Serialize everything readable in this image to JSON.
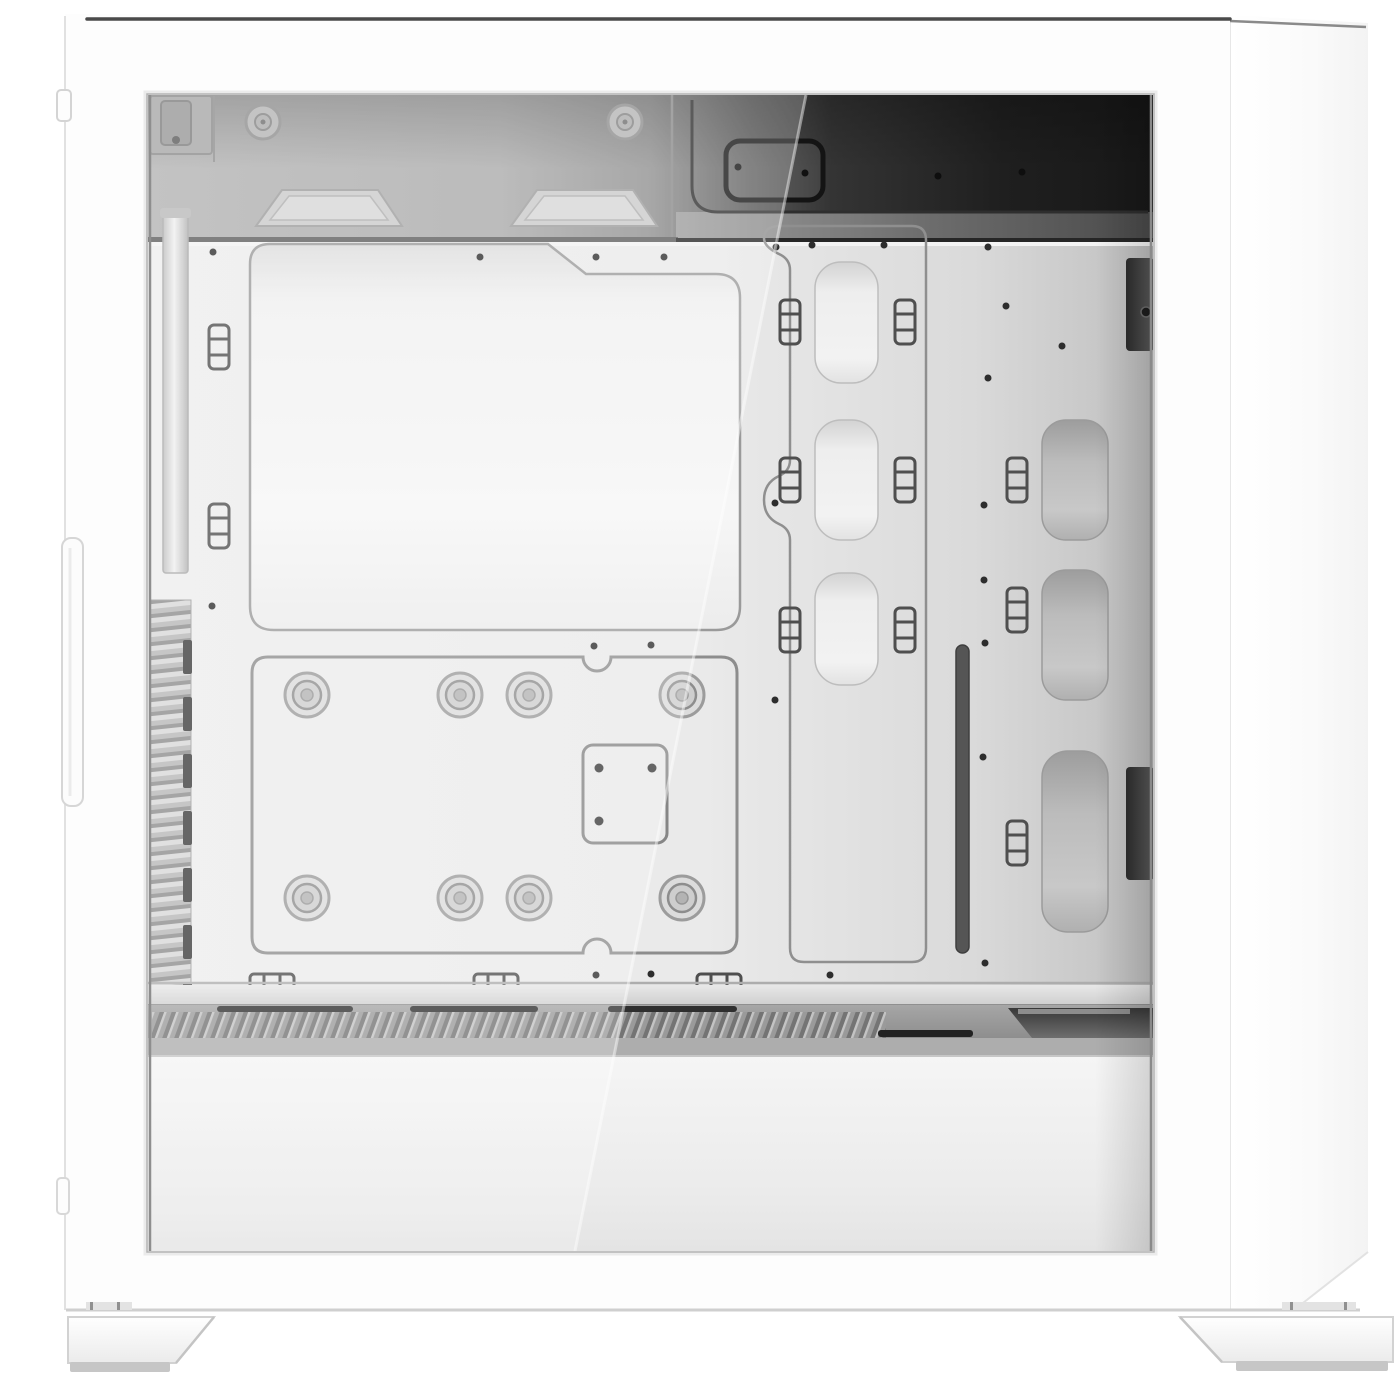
{
  "meta": {
    "image_type": "product-photo",
    "subject": "White mid-tower PC case, side view with tempered glass panel showing empty white interior",
    "visible_text": ""
  },
  "colors": {
    "background": "#ffffff",
    "case-white": "#fdfdfd",
    "top-line": "#4a4a4a",
    "outline": "#8f8f8f",
    "dot": "#2d2d2d",
    "tray-light": "#ececec",
    "tray-dark": "#c2c2c2",
    "band-light": "#b0b0b0",
    "band-dark": "#1b1b1b",
    "cutout-fill": "#f2f2f2",
    "shroud-gray": "#9a9a9a",
    "slot-dark": "#333333",
    "rail-gray": "#dedede",
    "foot-pad": "#c6c6c6"
  },
  "parts": {
    "stage": "White mid-tower PC case - left side view with tempered glass panel",
    "front_frame": "White case frame around glass panel",
    "side_panel": "Case right side face",
    "top_edge": "Case top edge line",
    "glass": "Tempered glass side window",
    "interior_top": "Interior ceiling area with fan mounting tabs",
    "ceiling_cutout": "Top cable routing cutout",
    "fan_tabs": "Top fan mounting tabs",
    "mb_tray": "Motherboard tray",
    "upper_cutout": "Motherboard tray upper cutout",
    "backplate_panel": "CPU backplate access panel",
    "grommets": "Standoff grommets on backplate panel",
    "cpu_square": "CPU backplate mounting square",
    "cable_column": "Cable routing channel with three cutouts",
    "column_cutouts": "Cable pass-through cutouts",
    "tie_clips": "Cable tie clips",
    "rear_cutouts": "Rear cable cutouts",
    "thin_slot": "Thin vertical vent slot",
    "rear_brackets": "Rear panel brackets seen through glass",
    "tray_rail": "Tray bottom rail",
    "psu_shroud": "Power supply shroud",
    "shroud_grille": "Shroud ventilation grille",
    "psu_recess": "PSU vent recess",
    "lower_band": "Lower white band behind glass",
    "front_vent": "Front intake vent louvers",
    "front_rail": "Front radiator mounting rail",
    "reflection": "Diagonal glass reflection",
    "seam": "Bottom panel seam",
    "foot_front": "Front case foot",
    "foot_rear": "Rear case foot",
    "edge_trim": "Side panel edge trim handle"
  },
  "counts": {
    "grommets": 8,
    "column_cutouts": 3,
    "rear_cutouts": 3,
    "shroud_slots": 3,
    "feet": 2
  }
}
